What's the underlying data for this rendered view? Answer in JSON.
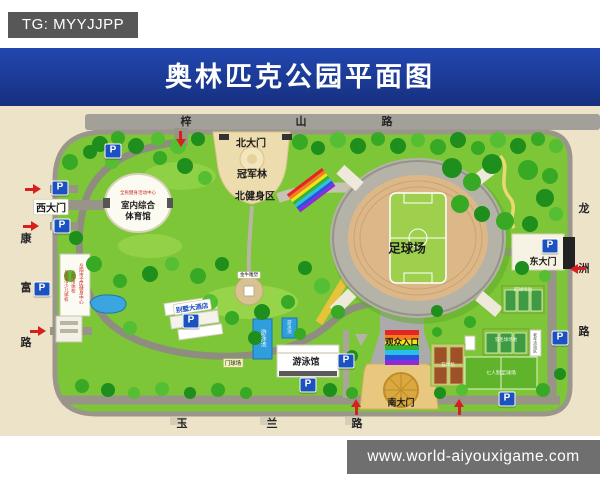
{
  "badge": {
    "text": "TG: MYYJJPP"
  },
  "title": "奥林匹克公园平面图",
  "site_watermark": "www.world-aiyouxigame.com",
  "parking": {
    "label": "P"
  },
  "roads": {
    "top": {
      "name": "梓山路",
      "chars": [
        "梓",
        "山",
        "路"
      ]
    },
    "left": {
      "name": "康富路",
      "chars": [
        "康",
        "富",
        "路"
      ]
    },
    "right": {
      "name": "龙洲路",
      "chars": [
        "龙",
        "洲",
        "路"
      ]
    },
    "bottom": {
      "name": "玉兰路",
      "chars": [
        "玉",
        "兰",
        "路"
      ]
    }
  },
  "gates": {
    "north": "北大门",
    "west": "西大门",
    "east": "东大门",
    "south": "南大门"
  },
  "places": {
    "champion_forest": "冠军林",
    "north_fitness_zone": "北健身区",
    "indoor_gym_line1": "室内综合",
    "indoor_gym_line2": "体育馆",
    "indoor_gym_subtitle": "全民健身活动中心",
    "football_field": "足球场",
    "spectator_entrance": "观众入口",
    "natatorium": "游泳馆",
    "swimming_pool": "游泳池",
    "gateball_court": "门球场",
    "golden_bull_statue": "金牛雕塑",
    "hotel": "别墅大酒店",
    "school_sign1": "岳阳市全民健身中心",
    "school_sign2": "岳阳市体校",
    "school_sign3": "岳阳市少儿体校",
    "court_tennis": "网球场地",
    "court_badminton": "羽毛球场地",
    "court_basketball": "篮球场",
    "court_football7": "七人制足球场",
    "senior_activity_area": "老年活动区"
  },
  "colors": {
    "title_bar": "#1c3da4",
    "badge_bg": "#575757",
    "watermark_bg": "#6f6f6f",
    "park_green": "#7cc637",
    "street_cream": "#ede3c9",
    "road_gray": "#a3a09a",
    "parking_blue": "#1b52c0",
    "arrow_red": "#d81f1f",
    "rainbow": [
      "#e42525",
      "#f07f1f",
      "#f3e11c",
      "#35b434",
      "#28c0e8",
      "#2b51e0",
      "#8e2bd8"
    ]
  }
}
